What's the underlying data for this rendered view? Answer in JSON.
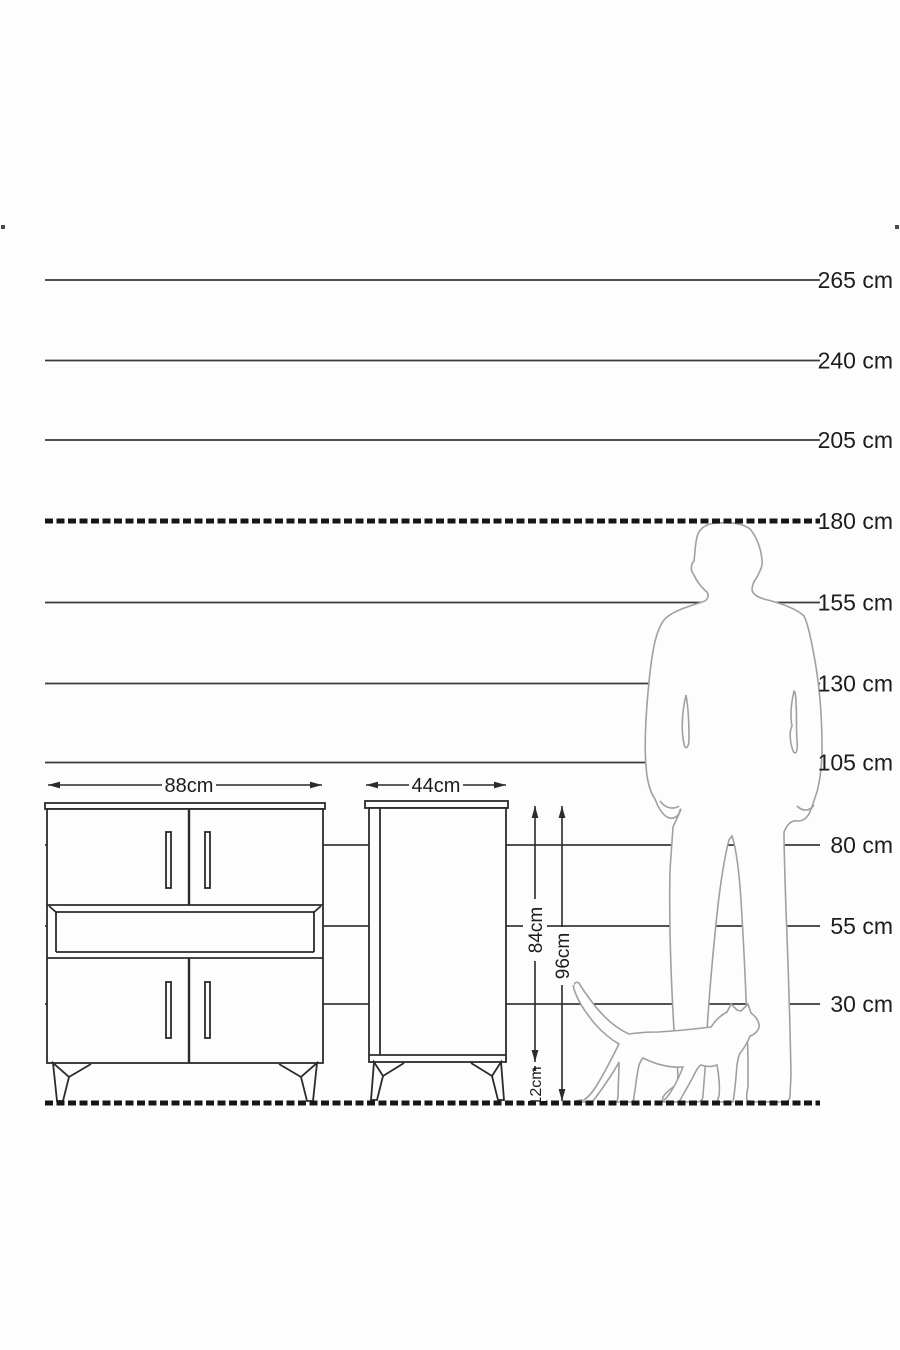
{
  "diagram_title": "furniture-height-scale-diagram",
  "colors": {
    "background": "#fdfdfd",
    "line": "#3a3a3a",
    "dashed_line": "#161616",
    "furniture_stroke": "#2b2b2b",
    "silhouette_stroke": "#a0a0a0",
    "text": "#1d1d1d"
  },
  "scale": {
    "unit": "cm",
    "lines": [
      {
        "label": "265 cm",
        "value_cm": 265,
        "style": "solid"
      },
      {
        "label": "240 cm",
        "value_cm": 240,
        "style": "solid"
      },
      {
        "label": "205 cm",
        "value_cm": 205,
        "style": "solid"
      },
      {
        "label": "180 cm",
        "value_cm": 180,
        "style": "dashed"
      },
      {
        "label": "155 cm",
        "value_cm": 155,
        "style": "solid"
      },
      {
        "label": "130 cm",
        "value_cm": 130,
        "style": "solid"
      },
      {
        "label": "105 cm",
        "value_cm": 105,
        "style": "solid"
      },
      {
        "label": "80 cm",
        "value_cm": 80,
        "style": "solid"
      },
      {
        "label": "55 cm",
        "value_cm": 55,
        "style": "solid"
      },
      {
        "label": "30 cm",
        "value_cm": 30,
        "style": "solid"
      }
    ],
    "ground": {
      "value_cm": 0,
      "style": "dashed"
    }
  },
  "furniture": {
    "wide_cabinet": {
      "width_label": "88cm",
      "doors": 4,
      "open_shelf": true
    },
    "narrow_cabinet": {
      "width_label": "44cm",
      "body_height_label": "84cm",
      "total_height_label": "96cm",
      "leg_height_label": "12cm"
    }
  },
  "figures": {
    "man": "standing man silhouette (approx. 180 cm)",
    "cat": "walking cat silhouette"
  }
}
